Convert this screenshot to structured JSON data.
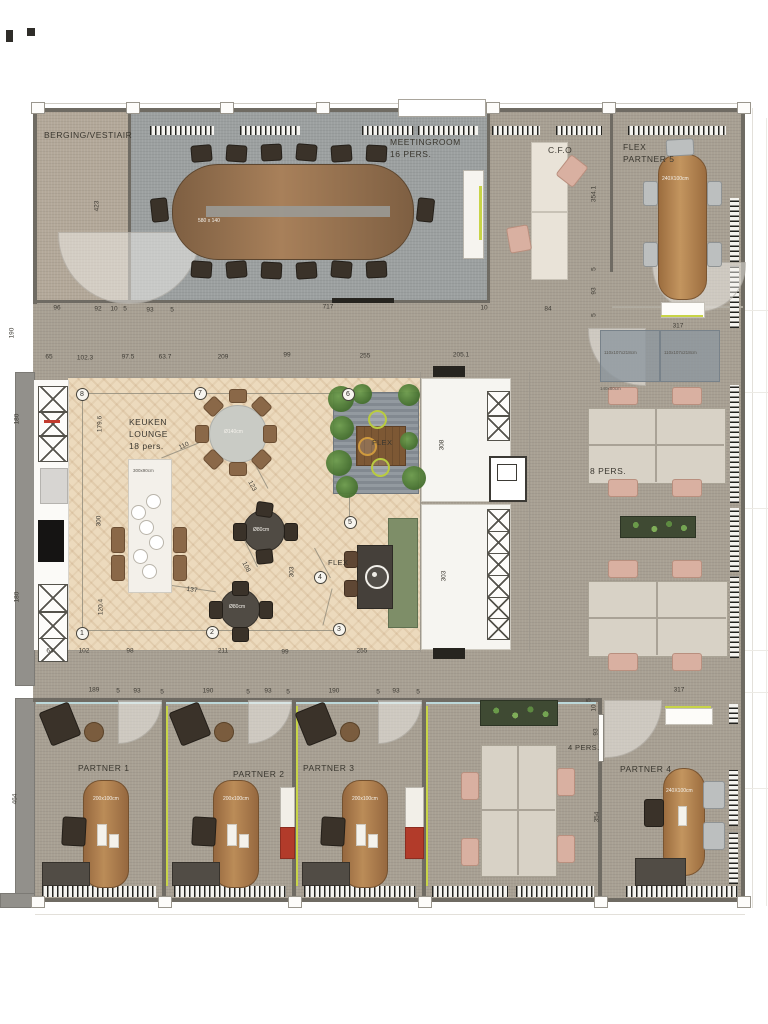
{
  "meta": {
    "drawing_type": "office floor plan"
  },
  "colors": {
    "accent_lime": "#c8d447",
    "accent_red": "#b23b2a",
    "carpet": "#a8a093",
    "parquet": "#ecdabd",
    "meeting_carpet": "#9ca0a0"
  },
  "rooms": {
    "berging": "BERGING/VESTIAIR",
    "meetingroom": "MEETINGROOM",
    "meetingroom_pers": "16 PERS.",
    "cfo": "C.F.O",
    "flex_partner5_line1": "FLEX",
    "flex_partner5_line2": "PARTNER 5",
    "keuken_line1": "KEUKEN",
    "keuken_line2": "LOUNGE",
    "keuken_line3": "18 pers.",
    "flex_platform": "FLEX",
    "flex_bench": "FLEX",
    "eight_pers": "8 PERS.",
    "four_pers": "4 PERS.",
    "partner1": "PARTNER 1",
    "partner2": "PARTNER 2",
    "partner3": "PARTNER 3",
    "partner4": "PARTNER 4"
  },
  "furniture_labels": {
    "meeting_table": "580 x 140",
    "fp5_table": "240X100cm",
    "locker": "110x107x218cm",
    "island": "300x90cm",
    "lounge_round_table": "Ø140cm",
    "bistro_table": "Ø80cm",
    "partner_desk": "200x100cm",
    "p4_table": "240X100cm",
    "cluster_desk": "140x80cm"
  },
  "texts": [
    {
      "name": "room-berging",
      "t": "BERGING/VESTIAIR",
      "x": 44,
      "y": 130,
      "cls": "room"
    },
    {
      "name": "room-meetingroom",
      "t": "MEETINGROOM",
      "x": 390,
      "y": 137,
      "cls": "room"
    },
    {
      "name": "room-meetingroom-pers",
      "t": "16 PERS.",
      "x": 390,
      "y": 149,
      "cls": "room"
    },
    {
      "name": "room-cfo",
      "t": "C.F.O",
      "x": 548,
      "y": 145,
      "cls": "room"
    },
    {
      "name": "room-fp5-1",
      "t": "FLEX",
      "x": 623,
      "y": 142,
      "cls": "room"
    },
    {
      "name": "room-fp5-2",
      "t": "PARTNER 5",
      "x": 623,
      "y": 154,
      "cls": "room"
    },
    {
      "name": "room-keuken-1",
      "t": "KEUKEN",
      "x": 129,
      "y": 417,
      "cls": "room"
    },
    {
      "name": "room-keuken-2",
      "t": "LOUNGE",
      "x": 129,
      "y": 429,
      "cls": "room"
    },
    {
      "name": "room-keuken-3",
      "t": "18 pers.",
      "x": 129,
      "y": 441,
      "cls": "room"
    },
    {
      "name": "label-flex-platform",
      "t": "FLEX",
      "x": 372,
      "y": 438,
      "cls": "room-sm"
    },
    {
      "name": "label-flex-bench",
      "t": "FLEX",
      "x": 328,
      "y": 558,
      "cls": "room-sm"
    },
    {
      "name": "room-8pers",
      "t": "8 PERS.",
      "x": 590,
      "y": 466,
      "cls": "room"
    },
    {
      "name": "room-4pers",
      "t": "4 PERS.",
      "x": 568,
      "y": 743,
      "cls": "room-sm"
    },
    {
      "name": "room-partner1",
      "t": "PARTNER 1",
      "x": 78,
      "y": 763,
      "cls": "room"
    },
    {
      "name": "room-partner2",
      "t": "PARTNER 2",
      "x": 233,
      "y": 769,
      "cls": "room"
    },
    {
      "name": "room-partner3",
      "t": "PARTNER 3",
      "x": 303,
      "y": 763,
      "cls": "room"
    },
    {
      "name": "room-partner4",
      "t": "PARTNER 4",
      "x": 620,
      "y": 764,
      "cls": "room"
    },
    {
      "name": "meeting-table-size",
      "t": "580 x 140",
      "x": 198,
      "y": 218,
      "cls": "fl"
    },
    {
      "name": "fp5-table-size",
      "t": "240X100cm",
      "x": 662,
      "y": 176,
      "cls": "fl"
    },
    {
      "name": "locker1-size",
      "t": "110x107x218cm",
      "x": 604,
      "y": 350,
      "cls": "fl-dark"
    },
    {
      "name": "locker2-size",
      "t": "110x107x218cm",
      "x": 664,
      "y": 350,
      "cls": "fl-dark"
    },
    {
      "name": "island-size",
      "t": "300x90cm",
      "x": 133,
      "y": 468,
      "cls": "fl-dark"
    },
    {
      "name": "lounge-table-size",
      "t": "Ø140cm",
      "x": 224,
      "y": 429,
      "cls": "fl"
    },
    {
      "name": "bistro1-size",
      "t": "Ø80cm",
      "x": 253,
      "y": 527,
      "cls": "fl"
    },
    {
      "name": "bistro2-size",
      "t": "Ø80cm",
      "x": 229,
      "y": 604,
      "cls": "fl"
    },
    {
      "name": "p1-desk-size",
      "t": "200x100cm",
      "x": 93,
      "y": 796,
      "cls": "fl"
    },
    {
      "name": "p2-desk-size",
      "t": "200x100cm",
      "x": 223,
      "y": 796,
      "cls": "fl"
    },
    {
      "name": "p3-desk-size",
      "t": "200x100cm",
      "x": 352,
      "y": 796,
      "cls": "fl"
    },
    {
      "name": "p4-table-size",
      "t": "240X100cm",
      "x": 666,
      "y": 788,
      "cls": "fl"
    },
    {
      "name": "cluster-desk-size",
      "t": "140x80cm",
      "x": 600,
      "y": 386,
      "cls": "fl-dark"
    }
  ],
  "dims": [
    {
      "t": "96",
      "x": 57,
      "y": 308
    },
    {
      "t": "92",
      "x": 98,
      "y": 309
    },
    {
      "t": "10",
      "x": 114,
      "y": 309
    },
    {
      "t": "5",
      "x": 125,
      "y": 309
    },
    {
      "t": "93",
      "x": 150,
      "y": 310
    },
    {
      "t": "5",
      "x": 172,
      "y": 310
    },
    {
      "t": "717",
      "x": 328,
      "y": 307
    },
    {
      "t": "10",
      "x": 484,
      "y": 308
    },
    {
      "t": "84",
      "x": 548,
      "y": 309
    },
    {
      "t": "65",
      "x": 49,
      "y": 357
    },
    {
      "t": "102.3",
      "x": 85,
      "y": 358
    },
    {
      "t": "97.5",
      "x": 128,
      "y": 357
    },
    {
      "t": "63.7",
      "x": 165,
      "y": 357
    },
    {
      "t": "209",
      "x": 223,
      "y": 357
    },
    {
      "t": "99",
      "x": 287,
      "y": 355
    },
    {
      "t": "255",
      "x": 365,
      "y": 356
    },
    {
      "t": "205.1",
      "x": 461,
      "y": 355
    },
    {
      "t": "63",
      "x": 50,
      "y": 651
    },
    {
      "t": "102",
      "x": 84,
      "y": 651
    },
    {
      "t": "98",
      "x": 130,
      "y": 651
    },
    {
      "t": "211",
      "x": 223,
      "y": 651
    },
    {
      "t": "99",
      "x": 285,
      "y": 652
    },
    {
      "t": "255",
      "x": 362,
      "y": 651
    },
    {
      "t": "189",
      "x": 94,
      "y": 690
    },
    {
      "t": "5",
      "x": 118,
      "y": 691
    },
    {
      "t": "93",
      "x": 137,
      "y": 691
    },
    {
      "t": "5",
      "x": 162,
      "y": 692
    },
    {
      "t": "190",
      "x": 208,
      "y": 691
    },
    {
      "t": "5",
      "x": 248,
      "y": 692
    },
    {
      "t": "93",
      "x": 268,
      "y": 691
    },
    {
      "t": "5",
      "x": 288,
      "y": 692
    },
    {
      "t": "190",
      "x": 334,
      "y": 691
    },
    {
      "t": "5",
      "x": 378,
      "y": 692
    },
    {
      "t": "93",
      "x": 396,
      "y": 691
    },
    {
      "t": "5",
      "x": 418,
      "y": 692
    },
    {
      "t": "317",
      "x": 678,
      "y": 326
    },
    {
      "t": "317",
      "x": 679,
      "y": 690
    },
    {
      "t": "190",
      "x": 12,
      "y": 333,
      "r": -90
    },
    {
      "t": "423",
      "x": 97,
      "y": 206,
      "r": -90
    },
    {
      "t": "354.1",
      "x": 594,
      "y": 194,
      "r": -90
    },
    {
      "t": "5",
      "x": 594,
      "y": 269,
      "r": -90
    },
    {
      "t": "93",
      "x": 594,
      "y": 291,
      "r": -90
    },
    {
      "t": "5",
      "x": 594,
      "y": 315,
      "r": -90
    },
    {
      "t": "180",
      "x": 17,
      "y": 419,
      "r": -90
    },
    {
      "t": "180",
      "x": 17,
      "y": 597,
      "r": -90
    },
    {
      "t": "464",
      "x": 15,
      "y": 799,
      "r": -90
    },
    {
      "t": "179.6",
      "x": 100,
      "y": 424,
      "r": -90
    },
    {
      "t": "300",
      "x": 99,
      "y": 521,
      "r": -90
    },
    {
      "t": "120.4",
      "x": 101,
      "y": 607,
      "r": -90
    },
    {
      "t": "303",
      "x": 292,
      "y": 572,
      "r": -90
    },
    {
      "t": "308",
      "x": 442,
      "y": 445,
      "r": -90
    },
    {
      "t": "303",
      "x": 444,
      "y": 576,
      "r": -90
    },
    {
      "t": "354",
      "x": 597,
      "y": 817,
      "r": -90
    },
    {
      "t": "93",
      "x": 596,
      "y": 732,
      "r": -90
    },
    {
      "t": "5",
      "x": 589,
      "y": 700,
      "r": -90
    },
    {
      "t": "10",
      "x": 594,
      "y": 708,
      "r": -90
    },
    {
      "t": "110",
      "x": 184,
      "y": 446,
      "r": -25
    },
    {
      "t": "123",
      "x": 252,
      "y": 486,
      "r": 62
    },
    {
      "t": "108",
      "x": 246,
      "y": 567,
      "r": 64
    },
    {
      "t": "137",
      "x": 192,
      "y": 590,
      "r": 8
    }
  ],
  "markers": [
    {
      "t": "1",
      "x": 82,
      "y": 633
    },
    {
      "t": "2",
      "x": 212,
      "y": 632
    },
    {
      "t": "3",
      "x": 339,
      "y": 629
    },
    {
      "t": "4",
      "x": 320,
      "y": 577
    },
    {
      "t": "5",
      "x": 350,
      "y": 522
    },
    {
      "t": "6",
      "x": 348,
      "y": 394
    },
    {
      "t": "7",
      "x": 200,
      "y": 393
    },
    {
      "t": "8",
      "x": 82,
      "y": 394
    }
  ]
}
